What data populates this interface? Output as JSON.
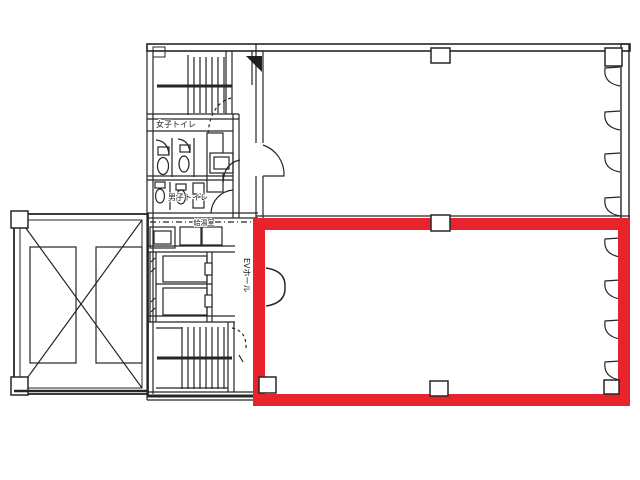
{
  "floorplan": {
    "labels": {
      "womens_toilet": "女子トイレ",
      "mens_toilet": "男子トイレ",
      "kitchenette": "給湯室",
      "ev_hall": "EVホール"
    },
    "highlight_color": "#e8232b",
    "line_color": "#262626"
  }
}
